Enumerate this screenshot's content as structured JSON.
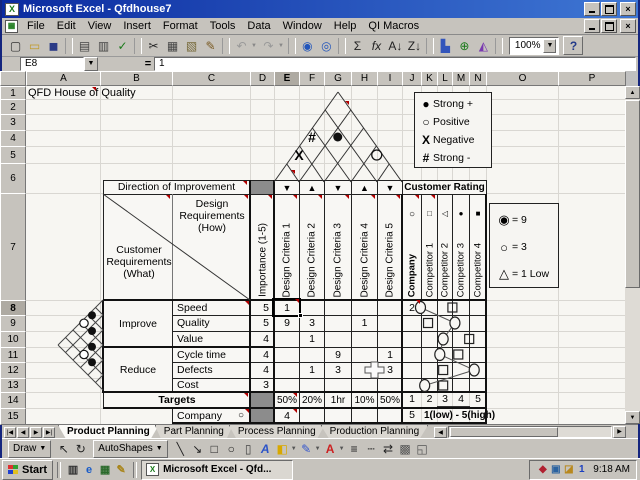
{
  "window": {
    "title": "Microsoft Excel - Qfdhouse7"
  },
  "menus": [
    "File",
    "Edit",
    "View",
    "Insert",
    "Format",
    "Tools",
    "Data",
    "Window",
    "Help",
    "QI Macros"
  ],
  "toolbar": {
    "zoom_value": "100%",
    "icons": [
      {
        "name": "new-document-icon",
        "glyph": "▢",
        "color": "#333333"
      },
      {
        "name": "open-icon",
        "glyph": "▭",
        "color": "#c09a28"
      },
      {
        "name": "save-icon",
        "glyph": "◼",
        "color": "#2a3a86"
      },
      {
        "name": "print-icon",
        "glyph": "▤",
        "color": "#444444"
      },
      {
        "name": "print-preview-icon",
        "glyph": "▥",
        "color": "#444444"
      },
      {
        "name": "spelling-icon",
        "glyph": "✓",
        "color": "#1a7a1a"
      },
      {
        "name": "cut-icon",
        "glyph": "✂",
        "color": "#222222"
      },
      {
        "name": "copy-icon",
        "glyph": "▦",
        "color": "#444444"
      },
      {
        "name": "paste-icon",
        "glyph": "▧",
        "color": "#776a3a"
      },
      {
        "name": "format-painter-icon",
        "glyph": "✎",
        "color": "#7a5a22"
      },
      {
        "name": "undo-icon",
        "glyph": "↶",
        "color": "#999999",
        "dropdown": true
      },
      {
        "name": "redo-icon",
        "glyph": "↷",
        "color": "#999999",
        "dropdown": true
      },
      {
        "name": "insert-hyperlink-icon",
        "glyph": "◉",
        "color": "#2255bb"
      },
      {
        "name": "web-toolbar-icon",
        "glyph": "◎",
        "color": "#2255bb"
      },
      {
        "name": "autosum-icon",
        "glyph": "Σ",
        "color": "#222222"
      },
      {
        "name": "paste-function-icon",
        "glyph": "fx",
        "color": "#222222"
      },
      {
        "name": "sort-ascending-icon",
        "glyph": "A↓",
        "color": "#222222"
      },
      {
        "name": "sort-descending-icon",
        "glyph": "Z↓",
        "color": "#222222"
      },
      {
        "name": "chart-wizard-icon",
        "glyph": "▙",
        "color": "#3355bb"
      },
      {
        "name": "map-icon",
        "glyph": "⊕",
        "color": "#1a7a1a"
      },
      {
        "name": "drawing-icon",
        "glyph": "◭",
        "color": "#7a3ab0"
      },
      {
        "name": "help-icon",
        "glyph": "?",
        "color": "#223a8a"
      }
    ]
  },
  "formula_bar": {
    "name_box": "E8",
    "equals": "=",
    "value": "1"
  },
  "sheet": {
    "columns": [
      "A",
      "B",
      "C",
      "D",
      "E",
      "F",
      "G",
      "H",
      "I",
      "J",
      "K",
      "L",
      "M",
      "N",
      "O",
      "P"
    ],
    "active_column": "E",
    "rows": [
      "1",
      "2",
      "3",
      "4",
      "5",
      "6",
      "7",
      "8",
      "9",
      "10",
      "11",
      "12",
      "13",
      "14",
      "15"
    ],
    "active_row": "8",
    "title_cell": "QFD House of Quality"
  },
  "house": {
    "direction_label": "Direction of Improvement",
    "direction_arrows": [
      "▼",
      "▲",
      "▼",
      "▲",
      "▼"
    ],
    "customer_rating_label": "Customer Rating",
    "how_label": "Design Requirements (How)",
    "what_label": "Customer Requirements (What)",
    "importance_label": "Importance (1-5)",
    "criteria": [
      "Design Criteria 1",
      "Design Criteria 2",
      "Design Criteria 3",
      "Design Criteria 4",
      "Design Criteria 5"
    ],
    "rating_columns": [
      {
        "label": "Company",
        "symbol": "○",
        "bold": true
      },
      {
        "label": "Competitor 1",
        "symbol": "□"
      },
      {
        "label": "Competitor 2",
        "symbol": "◁"
      },
      {
        "label": "Competitor 3",
        "symbol": "●"
      },
      {
        "label": "Competitor 4",
        "symbol": "■"
      }
    ],
    "roof_marks": [
      {
        "symbol": "X",
        "between": [
          1,
          2
        ]
      },
      {
        "symbol": "#",
        "between": [
          1,
          3
        ]
      },
      {
        "symbol": "●",
        "between": [
          2,
          4
        ]
      },
      {
        "symbol": "○",
        "between": [
          4,
          5
        ]
      }
    ],
    "left_marks": [
      {
        "symbol": "●",
        "between": [
          1,
          2
        ]
      },
      {
        "symbol": "○",
        "between": [
          1,
          3
        ]
      },
      {
        "symbol": "●",
        "between": [
          2,
          3
        ]
      },
      {
        "symbol": "●",
        "between": [
          3,
          4
        ]
      },
      {
        "symbol": "○",
        "between": [
          3,
          5
        ]
      },
      {
        "symbol": "●",
        "between": [
          4,
          5
        ]
      }
    ],
    "groups": [
      {
        "label": "Improve"
      },
      {
        "label": "Reduce"
      }
    ],
    "requirements": [
      {
        "name": "Speed",
        "importance": "5",
        "matrix": [
          "1",
          "",
          "",
          "",
          ""
        ],
        "company_value": "2",
        "circle": 1.6,
        "square": 3.5
      },
      {
        "name": "Quality",
        "importance": "5",
        "matrix": [
          "9",
          "3",
          "",
          "1",
          ""
        ],
        "company_value": "",
        "circle": 3.65,
        "square": 2.05
      },
      {
        "name": "Value",
        "importance": "4",
        "matrix": [
          "",
          "1",
          "",
          "",
          ""
        ],
        "company_value": "",
        "circle": 2.95,
        "square": 4.5
      },
      {
        "name": "Cycle time",
        "importance": "4",
        "matrix": [
          "",
          "",
          "9",
          "",
          "1"
        ],
        "company_value": "",
        "circle": 2.75,
        "square": 3.85
      },
      {
        "name": "Defects",
        "importance": "4",
        "matrix": [
          "",
          "1",
          "3",
          "",
          "3"
        ],
        "company_value": "",
        "circle": 4.8,
        "square": 2.95
      },
      {
        "name": "Cost",
        "importance": "3",
        "matrix": [
          "",
          "",
          "",
          "",
          ""
        ],
        "company_value": "",
        "circle": 1.85,
        "square": 2.95
      }
    ],
    "targets": {
      "label": "Targets",
      "values": [
        "50%",
        "20%",
        "1hr",
        "10%",
        "50%"
      ],
      "scale": [
        "1",
        "2",
        "3",
        "4",
        "5"
      ]
    },
    "company_row": {
      "label": "Company",
      "symbol": "○",
      "importance_value": "4",
      "scale_value": "5",
      "note": "1(low) - 5(high)"
    },
    "roof_legend": [
      {
        "symbol": "●",
        "label": "Strong +"
      },
      {
        "symbol": "○",
        "label": "Positive"
      },
      {
        "symbol": "X",
        "label": "Negative"
      },
      {
        "symbol": "#",
        "label": "Strong -"
      }
    ],
    "rating_legend": [
      {
        "symbol": "◉",
        "label": "= 9"
      },
      {
        "symbol": "○",
        "label": "= 3"
      },
      {
        "symbol": "△",
        "label": "= 1 Low"
      }
    ]
  },
  "tabs": {
    "items": [
      "Product Planning",
      "Part Planning",
      "Process Planning",
      "Production Planning"
    ],
    "active": "Product Planning"
  },
  "drawing_toolbar": {
    "draw_label": "Draw",
    "autoshapes_label": "AutoShapes",
    "icons": [
      {
        "name": "select-pointer-icon",
        "glyph": "↖",
        "color": "#222222"
      },
      {
        "name": "free-rotate-icon",
        "glyph": "↻",
        "color": "#222222"
      },
      {
        "name": "line-icon",
        "glyph": "╲",
        "color": "#222222"
      },
      {
        "name": "arrow-icon",
        "glyph": "↘",
        "color": "#222222"
      },
      {
        "name": "rectangle-icon",
        "glyph": "□",
        "color": "#222222"
      },
      {
        "name": "oval-icon",
        "glyph": "○",
        "color": "#222222"
      },
      {
        "name": "text-box-icon",
        "glyph": "▯",
        "color": "#444444"
      },
      {
        "name": "wordart-icon",
        "glyph": "A",
        "color": "#2a52c8"
      },
      {
        "name": "fill-color-icon",
        "glyph": "◧",
        "color": "#d8a800",
        "dropdown": true
      },
      {
        "name": "line-color-icon",
        "glyph": "✎",
        "color": "#3355cc",
        "dropdown": true
      },
      {
        "name": "font-color-icon",
        "glyph": "A",
        "color": "#cc2222",
        "dropdown": true
      },
      {
        "name": "line-style-icon",
        "glyph": "≡",
        "color": "#222222"
      },
      {
        "name": "dash-style-icon",
        "glyph": "┄",
        "color": "#222222"
      },
      {
        "name": "arrow-style-icon",
        "glyph": "⇄",
        "color": "#222222"
      },
      {
        "name": "shadow-icon",
        "glyph": "▩",
        "color": "#555555"
      },
      {
        "name": "threed-icon",
        "glyph": "◱",
        "color": "#555555"
      }
    ]
  },
  "taskbar": {
    "start_label": "Start",
    "task_label": "Microsoft Excel - Qfd...",
    "clock": "9:18 AM",
    "quick_launch": [
      {
        "name": "view-channels-icon",
        "glyph": "▥",
        "color": "#333333"
      },
      {
        "name": "internet-explorer-icon",
        "glyph": "e",
        "color": "#1a5cc8"
      },
      {
        "name": "show-desktop-icon",
        "glyph": "▦",
        "color": "#2a6a2a"
      },
      {
        "name": "outlook-express-icon",
        "glyph": "✎",
        "color": "#a88418"
      }
    ],
    "tray_icons": [
      {
        "name": "antivirus-shield-tray-icon",
        "glyph": "◆",
        "color": "#b02030"
      },
      {
        "name": "display-settings-tray-icon",
        "glyph": "▣",
        "color": "#2a62a0"
      },
      {
        "name": "scheduler-tray-icon",
        "glyph": "◪",
        "color": "#b8881e"
      },
      {
        "name": "messenger-tray-icon",
        "glyph": "1",
        "color": "#1b3fc0"
      }
    ]
  }
}
